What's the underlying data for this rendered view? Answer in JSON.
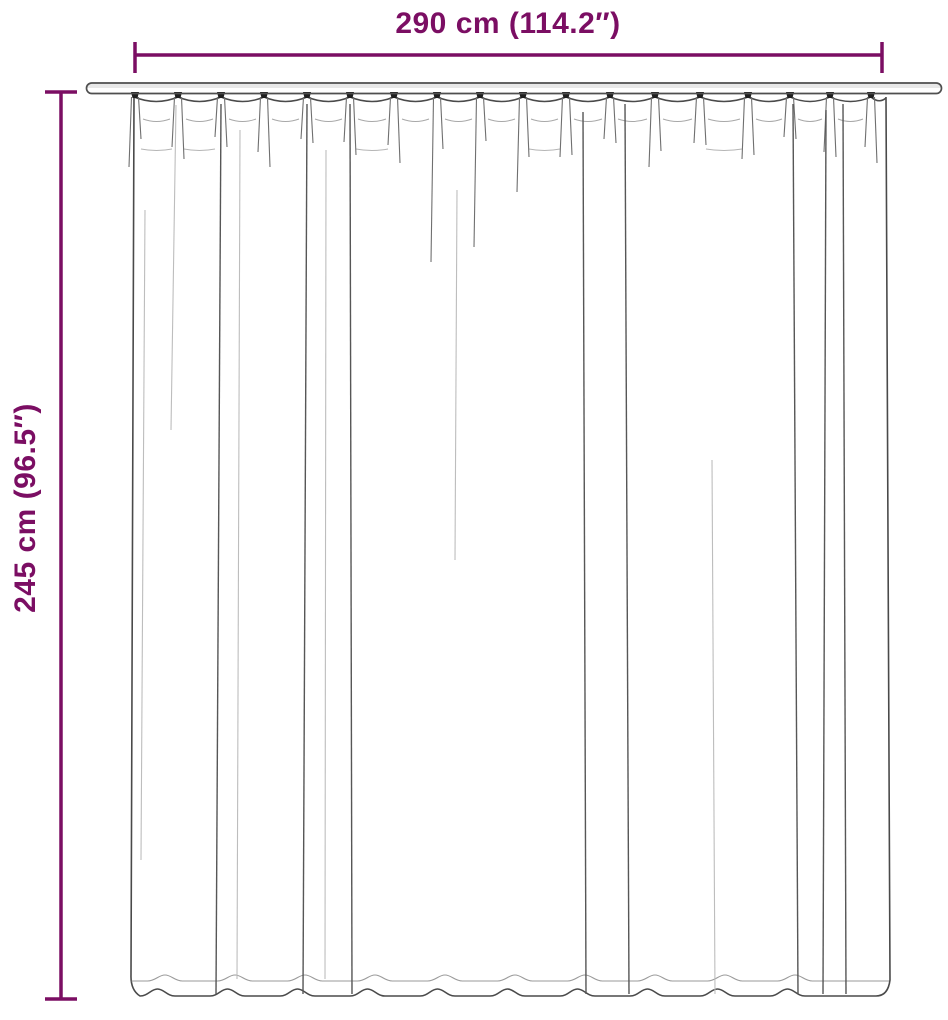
{
  "diagram": {
    "width_label": "290 cm (114.2″)",
    "height_label": "245 cm (96.5″)",
    "accent_color": "#7b0e63",
    "outline_color": "#4a4a4a"
  }
}
